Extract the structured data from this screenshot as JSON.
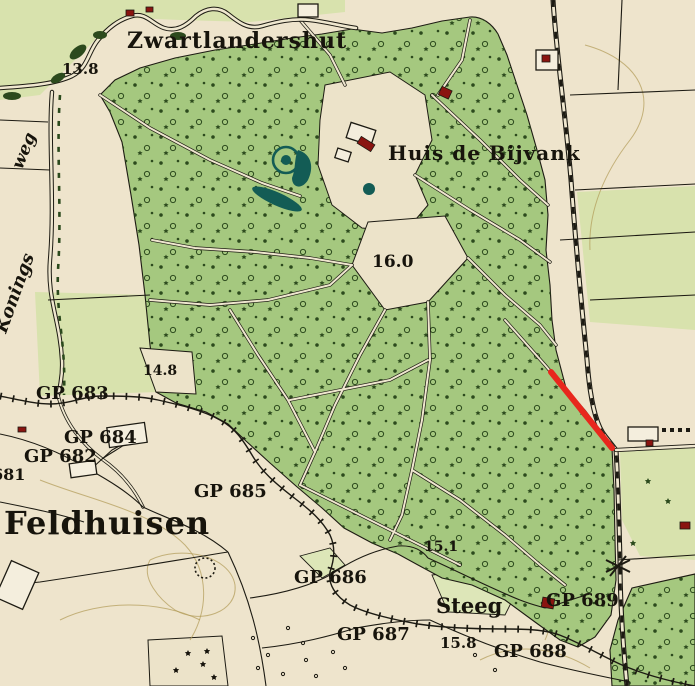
{
  "map": {
    "kind": "historical-topographic-map",
    "labels": {
      "zwartlandershut": "Zwartlandershut",
      "elev_13_8": "13.8",
      "weg": "weg",
      "konings": "Konings",
      "huis_de_bijvank": "Huis de Bijvank",
      "elev_16_0": "16.0",
      "elev_14_8": "14.8",
      "gp_683": "GP 683",
      "gp_684": "GP 684",
      "gp_682": "GP 682",
      "gp_681_fragment": "681",
      "feldhuisen": "Feldhuisen",
      "gp_685": "GP 685",
      "elev_15_1": "15.1",
      "gp_686": "GP 686",
      "steeg": "Steeg",
      "gp_687": "GP 687",
      "elev_15_8": "15.8",
      "gp_688": "GP 688",
      "gp_689": "GP 689"
    },
    "palette": {
      "paper": "#eee4cc",
      "field_green": "#d8e2ad",
      "forest_green": "#a5c87f",
      "tree_symbol_green": "#2c4a1d",
      "ink_black": "#1c1a12",
      "water_teal": "#135c55",
      "building_red": "#8a1410",
      "contour_olive": "#b09a56",
      "annotation_red": "#e8271d"
    },
    "annotation": {
      "red_line": {
        "x1": 551,
        "y1": 372,
        "x2": 612,
        "y2": 448,
        "color": "#e8271d",
        "width": 6
      }
    }
  }
}
